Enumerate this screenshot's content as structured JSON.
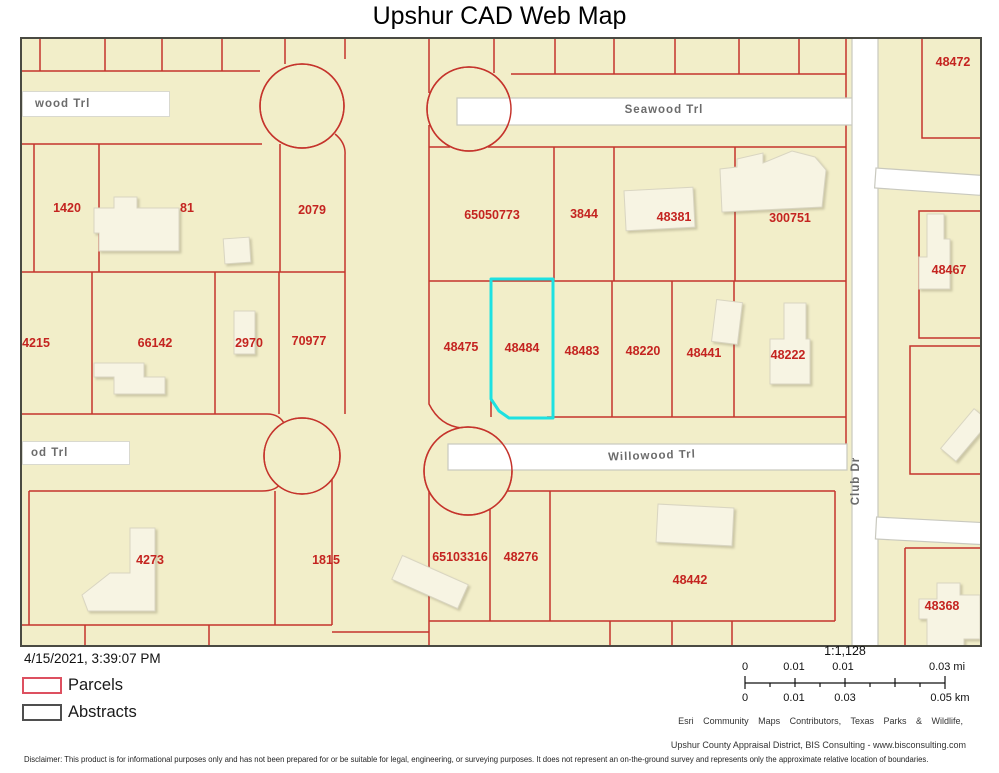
{
  "title": "Upshur CAD Web Map",
  "map": {
    "highlighted_parcel": "48484",
    "streets": {
      "wood_partial": "wood Trl",
      "seawood": "Seawood Trl",
      "od_partial": "od Trl",
      "willowood": "Willowood Trl",
      "club_dr": "Club Dr"
    },
    "parcels": [
      {
        "label": "1420"
      },
      {
        "label": "81"
      },
      {
        "label": "2079"
      },
      {
        "label": "4215"
      },
      {
        "label": "66142"
      },
      {
        "label": "2970"
      },
      {
        "label": "70977"
      },
      {
        "label": "4273"
      },
      {
        "label": "1815"
      },
      {
        "label": "65050773"
      },
      {
        "label": "3844"
      },
      {
        "label": "48381"
      },
      {
        "label": "300751"
      },
      {
        "label": "48475"
      },
      {
        "label": "48484"
      },
      {
        "label": "48483"
      },
      {
        "label": "48220"
      },
      {
        "label": "48441"
      },
      {
        "label": "48222"
      },
      {
        "label": "65103316"
      },
      {
        "label": "48276"
      },
      {
        "label": "48442"
      },
      {
        "label": "48472"
      },
      {
        "label": "48467"
      },
      {
        "label": "48368"
      }
    ],
    "colors": {
      "background": "#f2eec9",
      "parcel_line": "#c5342c",
      "parcel_label": "#c42420",
      "highlight": "#1ee1e1",
      "road": "#ffffff"
    }
  },
  "legend": {
    "timestamp": "4/15/2021, 3:39:07 PM",
    "items": [
      {
        "label": "Parcels",
        "swatch_border": "#dd5060"
      },
      {
        "label": "Abstracts",
        "swatch_border": "#4f4f4f"
      }
    ]
  },
  "scale": {
    "ratio": "1:1,128",
    "mi_ticks": [
      "0",
      "0.01",
      "0.01",
      "0.03 mi"
    ],
    "km_ticks": [
      "0",
      "0.01",
      "0.03",
      "0.05 km"
    ]
  },
  "attribution": {
    "line1": "Esri Community Maps Contributors, Texas Parks & Wildlife,",
    "line2": "Upshur County Appraisal District, BIS Consulting - www.bisconsulting.com"
  },
  "disclaimer": "Disclaimer: This product is for informational purposes only and has not been prepared for or be suitable for legal, engineering, or surveying purposes. It does not represent an on-the-ground survey and represents only the approximate relative location of boundaries."
}
